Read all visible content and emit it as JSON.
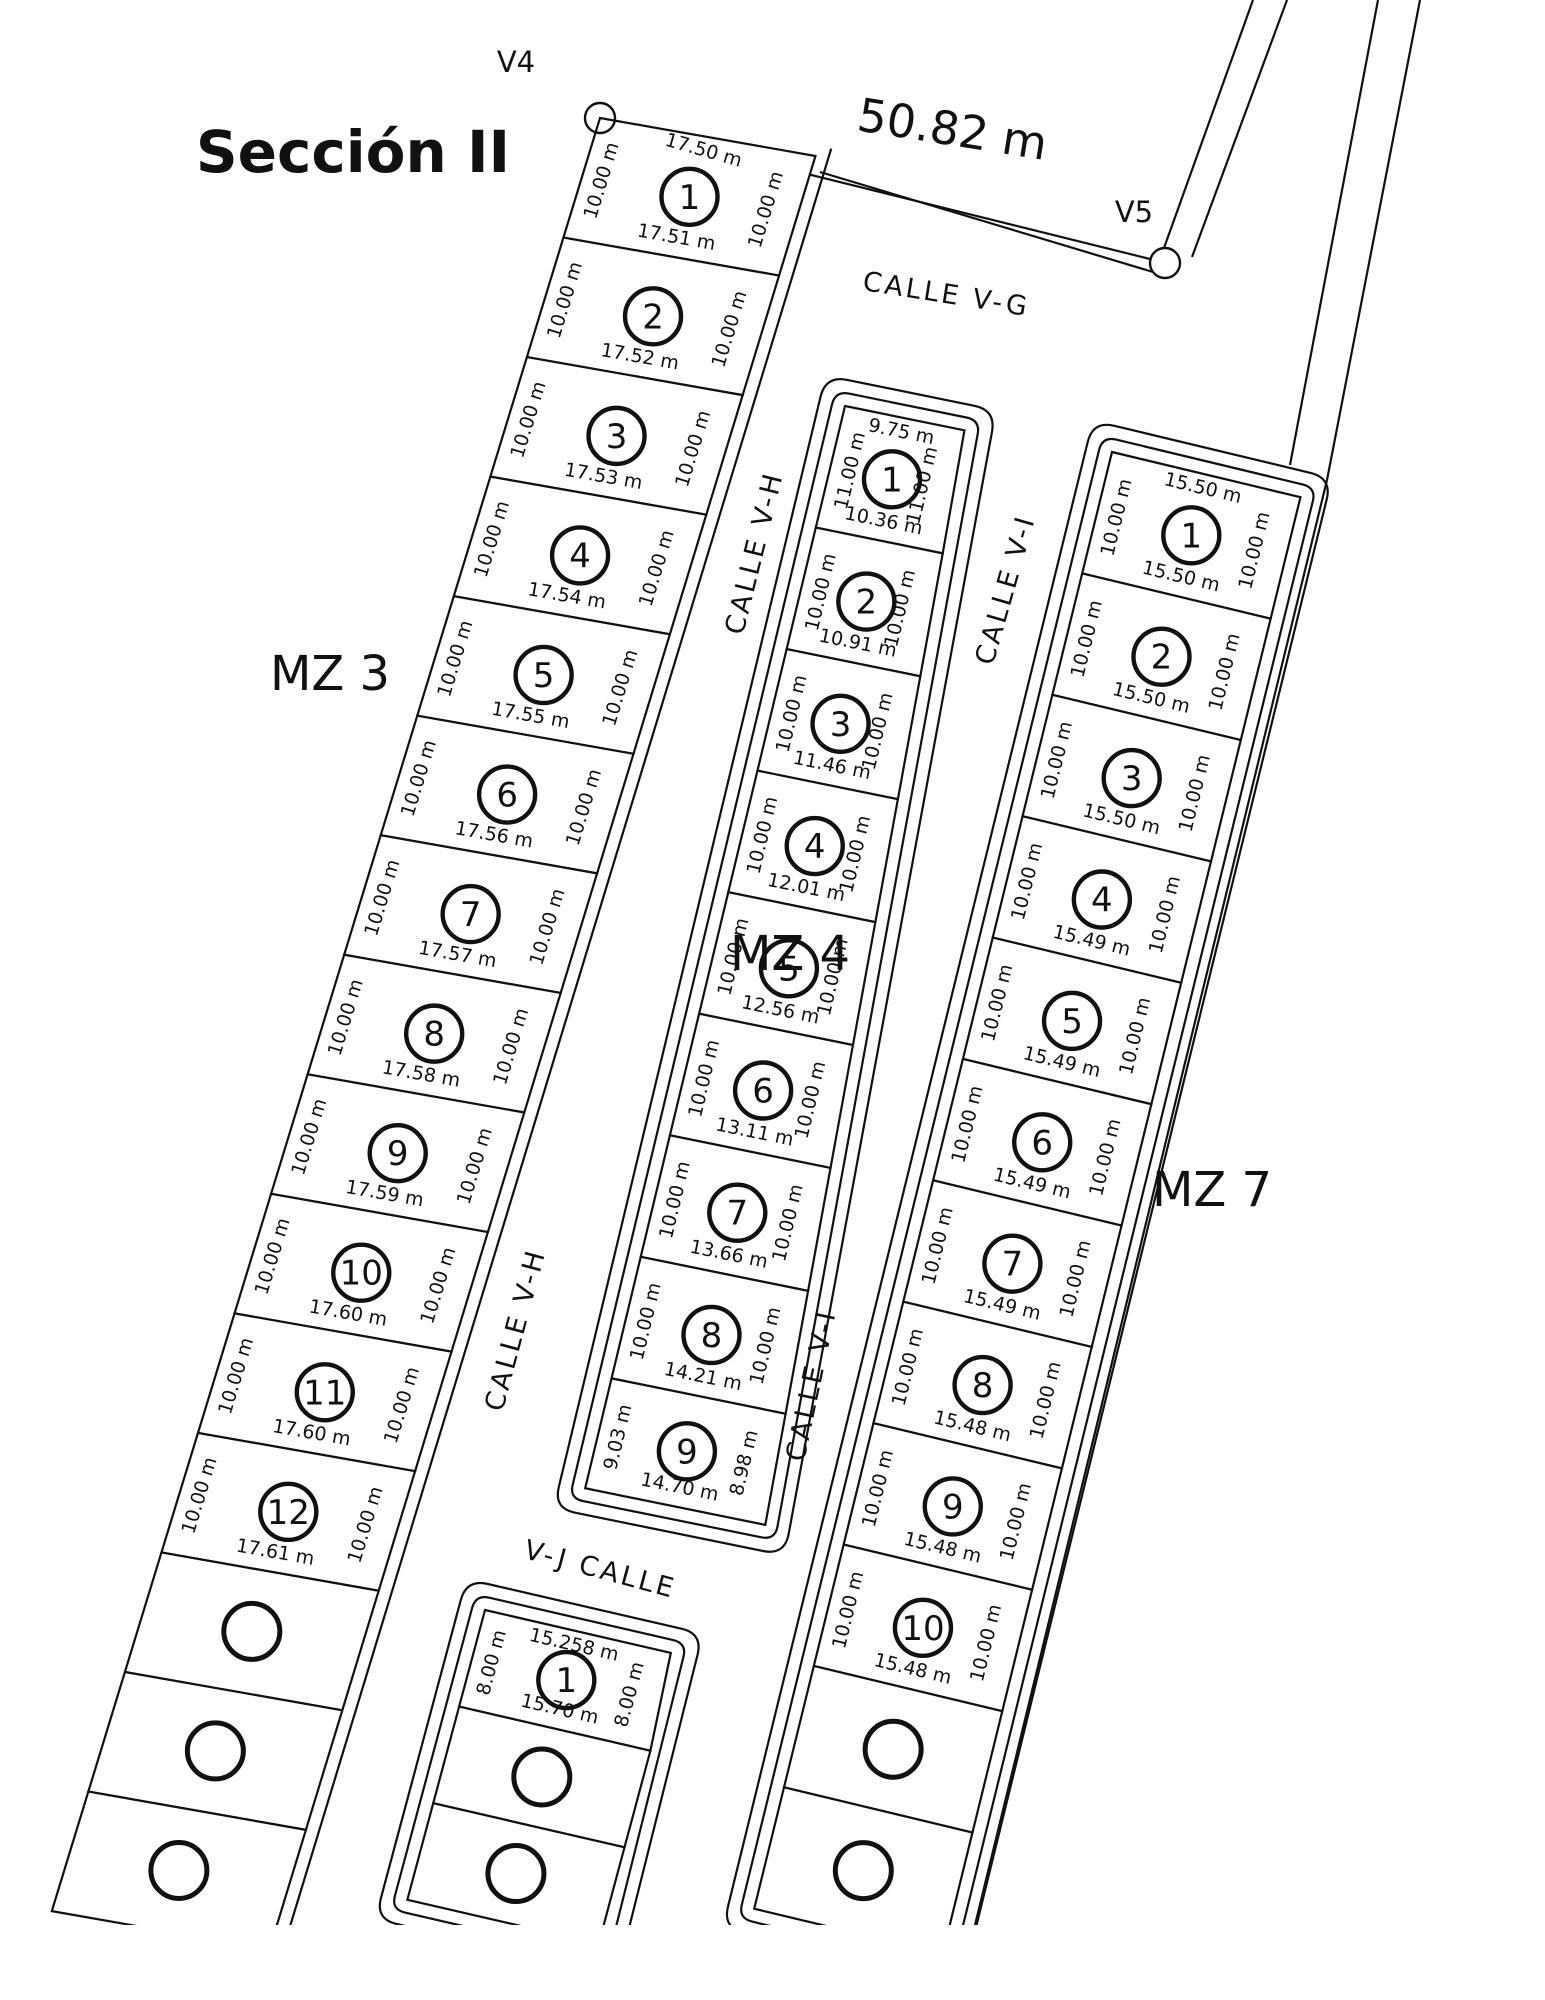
{
  "colors": {
    "ink": "#111111",
    "paper": "#ffffff"
  },
  "title": "Sección II",
  "top_measure": "50.82 m",
  "vertices": [
    {
      "id": "V4"
    },
    {
      "id": "V5"
    }
  ],
  "streets": [
    {
      "id": "v-g",
      "label": "CALLE  V-G"
    },
    {
      "id": "v-h-upper",
      "label": "CALLE  V-H"
    },
    {
      "id": "v-h-lower",
      "label": "CALLE  V-H"
    },
    {
      "id": "v-i-upper",
      "label": "CALLE  V-I"
    },
    {
      "id": "v-i-lower",
      "label": "CALLE  V-I"
    },
    {
      "id": "v-j",
      "label": "V-J  CALLE"
    }
  ],
  "blocks": [
    {
      "label": "MZ 3",
      "top_dim": "17.50 m",
      "lots": [
        {
          "num": "1",
          "left": "10.00 m",
          "right": "10.00 m",
          "bottom": "17.51 m"
        },
        {
          "num": "2",
          "left": "10.00 m",
          "right": "10.00 m",
          "bottom": "17.52 m"
        },
        {
          "num": "3",
          "left": "10.00 m",
          "right": "10.00 m",
          "bottom": "17.53 m"
        },
        {
          "num": "4",
          "left": "10.00 m",
          "right": "10.00 m",
          "bottom": "17.54 m"
        },
        {
          "num": "5",
          "left": "10.00 m",
          "right": "10.00 m",
          "bottom": "17.55 m"
        },
        {
          "num": "6",
          "left": "10.00 m",
          "right": "10.00 m",
          "bottom": "17.56 m"
        },
        {
          "num": "7",
          "left": "10.00 m",
          "right": "10.00 m",
          "bottom": "17.57 m"
        },
        {
          "num": "8",
          "left": "10.00 m",
          "right": "10.00 m",
          "bottom": "17.58 m"
        },
        {
          "num": "9",
          "left": "10.00 m",
          "right": "10.00 m",
          "bottom": "17.59 m"
        },
        {
          "num": "10",
          "left": "10.00 m",
          "right": "10.00 m",
          "bottom": "17.60 m"
        },
        {
          "num": "11",
          "left": "10.00 m",
          "right": "10.00 m",
          "bottom": "17.60 m"
        },
        {
          "num": "12",
          "left": "10.00 m",
          "right": "10.00 m",
          "bottom": "17.61 m"
        },
        {},
        {},
        {}
      ]
    },
    {
      "label": "MZ 4",
      "top_dim": "9.75 m",
      "lots": [
        {
          "num": "1",
          "left": "11.00 m",
          "right": "11.00 m",
          "bottom": "10.36 m"
        },
        {
          "num": "2",
          "left": "10.00 m",
          "right": "10.00 m",
          "bottom": "10.91 m"
        },
        {
          "num": "3",
          "left": "10.00 m",
          "right": "10.00 m",
          "bottom": "11.46 m"
        },
        {
          "num": "4",
          "left": "10.00 m",
          "right": "10.00 m",
          "bottom": "12.01 m"
        },
        {
          "num": "5",
          "left": "10.00 m",
          "right": "10.00 m",
          "bottom": "12.56 m"
        },
        {
          "num": "6",
          "left": "10.00 m",
          "right": "10.00 m",
          "bottom": "13.11 m"
        },
        {
          "num": "7",
          "left": "10.00 m",
          "right": "10.00 m",
          "bottom": "13.66 m"
        },
        {
          "num": "8",
          "left": "10.00 m",
          "right": "10.00 m",
          "bottom": "14.21 m"
        },
        {
          "num": "9",
          "left": "9.03 m",
          "right": "8.98 m",
          "bottom": "14.70 m"
        }
      ]
    },
    {
      "label": "MZ 7",
      "top_dim": "15.50 m",
      "lots": [
        {
          "num": "1",
          "left": "10.00 m",
          "right": "10.00 m",
          "bottom": "15.50 m"
        },
        {
          "num": "2",
          "left": "10.00 m",
          "right": "10.00 m",
          "bottom": "15.50 m"
        },
        {
          "num": "3",
          "left": "10.00 m",
          "right": "10.00 m",
          "bottom": "15.50 m"
        },
        {
          "num": "4",
          "left": "10.00 m",
          "right": "10.00 m",
          "bottom": "15.49 m"
        },
        {
          "num": "5",
          "left": "10.00 m",
          "right": "10.00 m",
          "bottom": "15.49 m"
        },
        {
          "num": "6",
          "left": "10.00 m",
          "right": "10.00 m",
          "bottom": "15.49 m"
        },
        {
          "num": "7",
          "left": "10.00 m",
          "right": "10.00 m",
          "bottom": "15.49 m"
        },
        {
          "num": "8",
          "left": "10.00 m",
          "right": "10.00 m",
          "bottom": "15.48 m"
        },
        {
          "num": "9",
          "left": "10.00 m",
          "right": "10.00 m",
          "bottom": "15.48 m"
        },
        {
          "num": "10",
          "left": "10.00 m",
          "right": "10.00 m",
          "bottom": "15.48 m"
        },
        {},
        {}
      ]
    },
    {
      "label": "",
      "top_dim": "15.258 m",
      "lots": [
        {
          "num": "1",
          "left": "8.00 m",
          "right": "8.00 m",
          "bottom": "15.70 m"
        },
        {},
        {}
      ]
    }
  ]
}
